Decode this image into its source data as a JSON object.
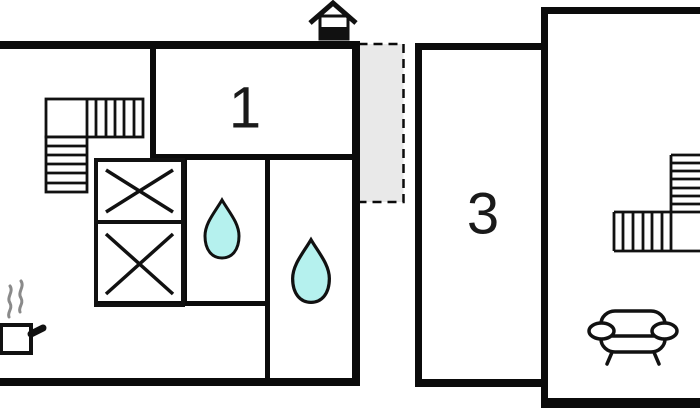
{
  "floorplan": {
    "room_labels": {
      "room1": "1",
      "room3": "3"
    },
    "colors": {
      "wall": "#0b0b0b",
      "line": "#111111",
      "water_drop_fill": "#b5f1ee",
      "porch_fill": "#e9e9e9",
      "steam_gray": "#8a8a8a",
      "background": "#ffffff"
    },
    "icons": [
      "house-entrance-icon",
      "water-drop-icon",
      "stove-steam-icon",
      "sofa-icon",
      "staircase-icon",
      "bed-cross-icon"
    ]
  }
}
